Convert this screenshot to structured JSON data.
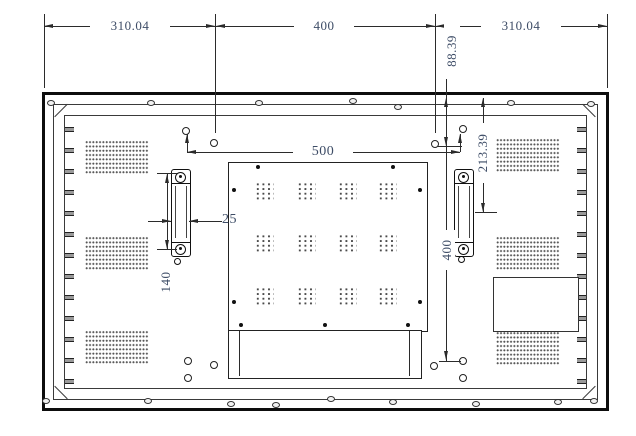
{
  "drawing": {
    "type": "rear-view-mounting-dimension-drawing",
    "units_note": "",
    "line_color": "#2b2b2b",
    "dim_text_color": "#3d4c66",
    "dims": {
      "top_left_margin": "310.04",
      "top_hole_span": "400",
      "top_right_margin": "310.04",
      "edge_to_top_hole_row": "88.39",
      "edge_to_handle_center": "213.39",
      "outer_hole_span": "500",
      "handle_width": "25",
      "handle_length": "140",
      "vertical_hole_span": "400"
    }
  }
}
